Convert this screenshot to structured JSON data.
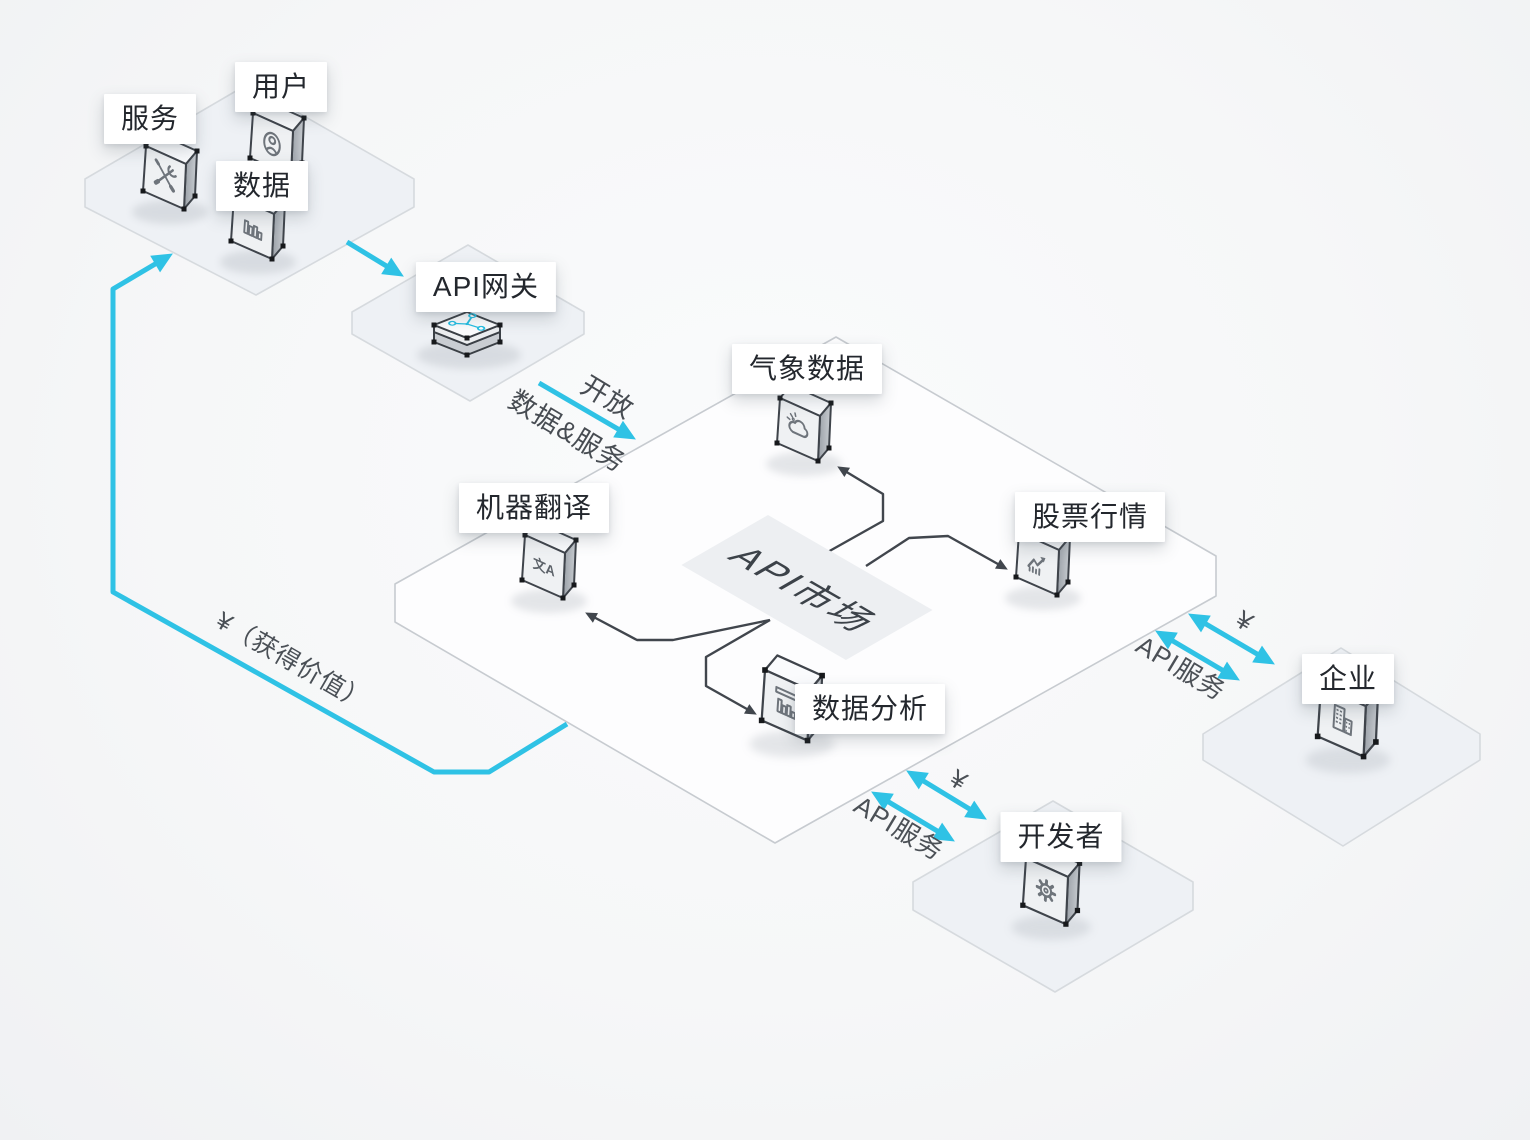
{
  "palette": {
    "accent_cyan": "#2fc2e5",
    "connector_dark": "#41464d",
    "small_plate_fill": "#eef1f5",
    "small_plate_stroke": "#d6dade",
    "main_plate_fill": "#fdfdfe",
    "main_plate_stroke": "#c7cbd0",
    "card_background": "#ffffff",
    "card_text": "#23272d",
    "icon_gray": "#6e747b",
    "market_tile_fill": "#edeff2"
  },
  "nodes": {
    "service": {
      "label": "服务",
      "icon": "tools-icon"
    },
    "user": {
      "label": "用户",
      "icon": "user-icon"
    },
    "data": {
      "label": "数据",
      "icon": "data-bars-icon"
    },
    "gateway": {
      "label": "API网关",
      "icon": "network-icon"
    },
    "weather": {
      "label": "气象数据",
      "icon": "cloud-icon"
    },
    "translate": {
      "label": "机器翻译",
      "icon": "translate-icon",
      "icon_glyph": "文A"
    },
    "stock": {
      "label": "股票行情",
      "icon": "stock-chart-icon"
    },
    "analysis": {
      "label": "数据分析",
      "icon": "bar-chart-icon"
    },
    "enterprise": {
      "label": "企业",
      "icon": "building-icon"
    },
    "developer": {
      "label": "开发者",
      "icon": "gear-icon"
    },
    "market": {
      "label": "API市场"
    }
  },
  "edges": {
    "gateway_to_market_line1": "开放",
    "gateway_to_market_line2": "数据&服务",
    "enterprise_fee": "¥",
    "enterprise_service": "API服务",
    "developer_fee": "¥",
    "developer_service": "API服务",
    "value_loop": "¥（获得价值）"
  }
}
